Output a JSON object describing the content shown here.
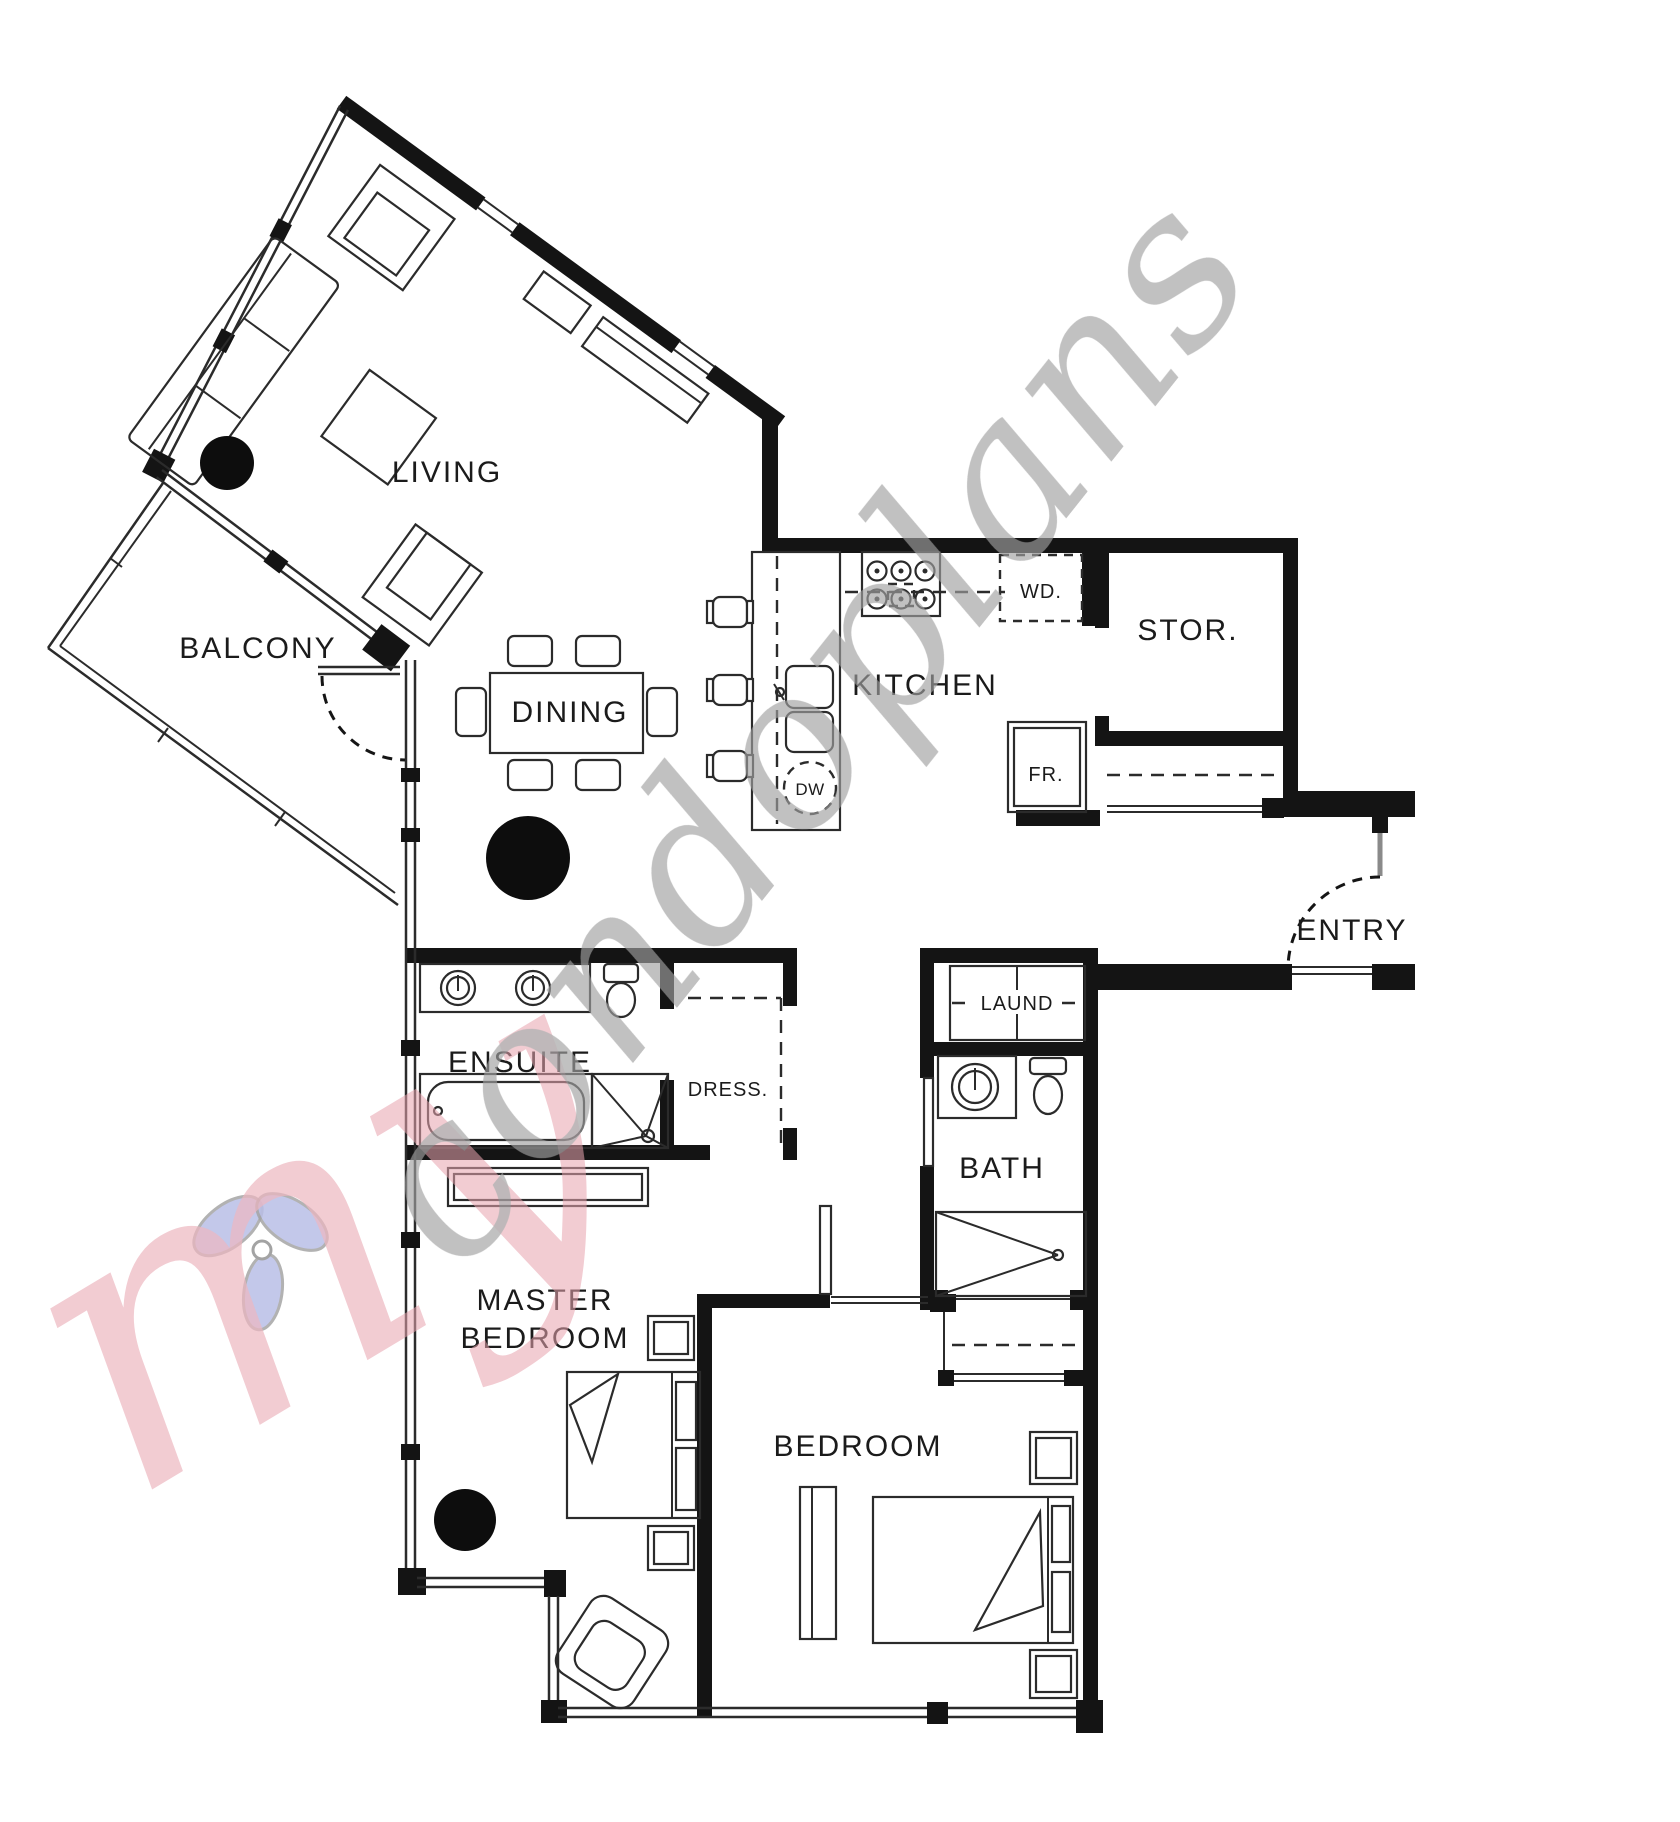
{
  "rooms": {
    "living": "LIVING",
    "balcony": "BALCONY",
    "dining": "DINING",
    "kitchen": "KITCHEN",
    "storage": "STOR.",
    "entry": "ENTRY",
    "ensuite": "ENSUITE",
    "dressing": "DRESS.",
    "laundry": "LAUND",
    "bath": "BATH",
    "master_line1": "MASTER",
    "master_line2": "BEDROOM",
    "bedroom": "BEDROOM"
  },
  "appliances": {
    "washer_dryer": "WD.",
    "fridge": "FR.",
    "dishwasher": "DW"
  },
  "watermark": {
    "script_prefix": "my",
    "script_name": "condoplans"
  },
  "colors": {
    "wall": "#141414",
    "line": "#2b2b2b",
    "background": "#ffffff",
    "watermark_gray": "#a2a2a2",
    "watermark_pink": "#e8a4b0",
    "watermark_blue": "#a7aee0"
  }
}
